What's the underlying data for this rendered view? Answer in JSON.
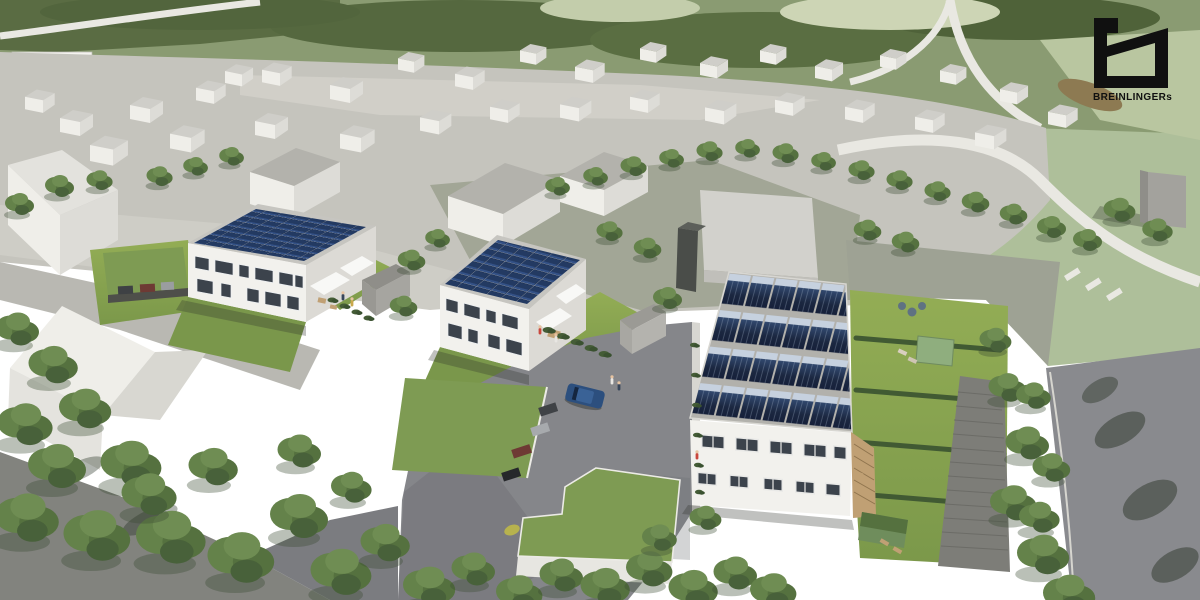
{
  "image": {
    "kind": "architectural aerial 3D rendering",
    "subject": "residential development of three new houses with rooftop photovoltaic panels",
    "context": "white massing-model village merged with aerial photo of fields and roads",
    "width_px": 1200,
    "height_px": 600
  },
  "branding": {
    "logo_text": "BREINLINGERs",
    "logo_color": "#101010"
  },
  "palette": {
    "solar_panel_dark": "#1b2740",
    "solar_panel_mid": "#233a62",
    "solar_panel_highlight": "#c6d1df",
    "wall_white": "#f2f1ed",
    "wall_shade": "#dcdad5",
    "massing_white": "#efeee9",
    "massing_roof_grey": "#b3b2ac",
    "village_ground": "#c5c4bd",
    "plaza_grey_green": "#a2a696",
    "aerial_green": "#8a9b72",
    "aerial_dark_woods": "#55683f",
    "road_white": "#e9e8e2",
    "lawn_green": "#8ba551",
    "asphalt": "#85868a",
    "tree_green": "#64824a",
    "hedge_green": "#445c36",
    "green_roof": "#7e9b53",
    "pergola_tan": "#c0a074",
    "car_blue": "#2c4f7e"
  },
  "scene": {
    "site_buildings": [
      {
        "id": "house-west",
        "type": "two-story duplex, flat roof",
        "roof": "full-coverage solar array",
        "features": "white awnings, terraces, garden"
      },
      {
        "id": "house-center",
        "type": "two-story duplex, flat roof",
        "roof": "full-coverage solar array",
        "features": "white awnings, garden shed"
      },
      {
        "id": "rowhouse-east",
        "type": "two-story terraced row",
        "roof": "four rows of tilted solar arrays",
        "features": "wooden pergola, hedged private gardens"
      }
    ],
    "context_buildings": "untextured white massing-model houses of the surrounding village",
    "landscape": {
      "lawns": "yellow-green lawns around houses",
      "gardens": "hedge-divided gardens east of rowhouse with pavilion and loungers",
      "trees": "street tree rows and dense foreground canopy",
      "green_roofs": [
        "carport row",
        "stepped garage court building",
        "garden shed"
      ]
    },
    "paving": {
      "court": "asphalt parking court",
      "walkways": "light concrete paths and stepped walkway",
      "road_east": "asphalt street with tree shadows",
      "background_roads": "white country roads in aerial photo"
    },
    "vehicles": [
      {
        "id": "blue-car",
        "color": "#2c4f7e"
      },
      {
        "id": "carport-cars",
        "colors": [
          "#3f4246",
          "#6e3a34",
          "#a7aaad",
          "#26282b"
        ]
      }
    ]
  }
}
